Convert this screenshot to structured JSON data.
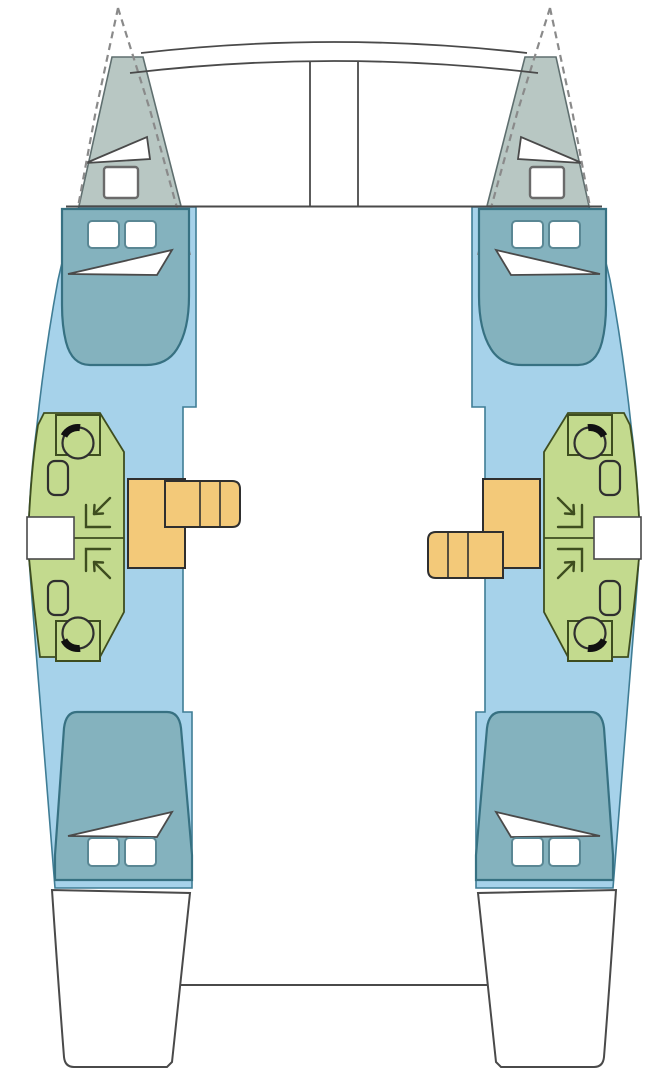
{
  "meta": {
    "description": "Top-down interior layout plan of a 4-cabin, 4-head sailing catamaran; no text labels are rendered in the drawing",
    "visible_text": []
  },
  "colors": {
    "background": "#ffffff",
    "outline": "#4a4a4a",
    "dashed_outline": "#8a8a8a",
    "forepeak_fill": "#b8c7c3",
    "forepeak_border": "#5f6f6f",
    "cabin_floor_fill": "#a6d2ea",
    "cabin_floor_border": "#3f7d95",
    "bed_fill": "#84b2be",
    "bed_border": "#377182",
    "bed_pillow_border": "#5a8794",
    "bathroom_fill": "#c3da8e",
    "bathroom_border": "#3e4d1f",
    "stairs_fill": "#f3c979",
    "stairs_border": "#2f2f2f",
    "fixture_white": "#ffffff",
    "toilet_seat_black": "#111111"
  },
  "areas": {
    "port_hull": [
      "forepeak-locker",
      "forward-cabin-berth",
      "forward-head-toilet",
      "forward-head-sink",
      "forward-shower",
      "aft-shower",
      "aft-head-sink",
      "aft-head-toilet",
      "aft-cabin-berth",
      "companionway-stairs",
      "transom-steps"
    ],
    "starboard_hull": [
      "forepeak-locker",
      "forward-cabin-berth",
      "forward-head-toilet",
      "forward-head-sink",
      "forward-shower",
      "aft-shower",
      "aft-head-sink",
      "aft-head-toilet",
      "aft-cabin-berth",
      "companionway-stairs",
      "transom-steps"
    ],
    "center": [
      "foredeck-crossbeams",
      "anchor-channel",
      "bridgedeck-saloon",
      "aft-cockpit-edge"
    ]
  }
}
